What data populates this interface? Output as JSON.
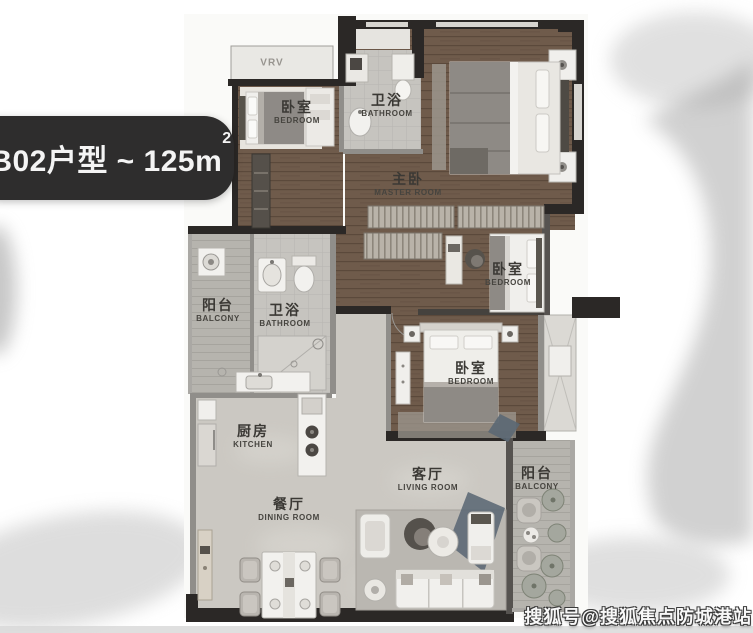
{
  "title": {
    "main": "B02户型 ~ 125m",
    "sup": "2"
  },
  "hvac": {
    "label": "VRV"
  },
  "rooms": [
    {
      "id": "bedroom-top-left",
      "cn": "卧室",
      "en": "BEDROOM"
    },
    {
      "id": "bathroom-top",
      "cn": "卫浴",
      "en": "BATHROOM"
    },
    {
      "id": "master-bedroom",
      "cn": "主卧",
      "en": "MASTER ROOM"
    },
    {
      "id": "bedroom-right",
      "cn": "卧室",
      "en": "BEDROOM"
    },
    {
      "id": "bedroom-bottom",
      "cn": "卧室",
      "en": "BEDROOM"
    },
    {
      "id": "balcony-left",
      "cn": "阳台",
      "en": "BALCONY"
    },
    {
      "id": "bathroom-left",
      "cn": "卫浴",
      "en": "BATHROOM"
    },
    {
      "id": "kitchen",
      "cn": "厨房",
      "en": "KITCHEN"
    },
    {
      "id": "dining-room",
      "cn": "餐厅",
      "en": "DINING ROOM"
    },
    {
      "id": "living-room",
      "cn": "客厅",
      "en": "LIVING ROOM"
    },
    {
      "id": "balcony-right",
      "cn": "阳台",
      "en": "BALCONY"
    }
  ],
  "watermark": "搜狐号@搜狐焦点防城港站",
  "colors": {
    "badge_bg": "#2e2d2d",
    "wall_dark": "#2b2826",
    "wall_gray": "#908e8a",
    "wood": "#6f5b4b",
    "marble": "#cbc8c2",
    "tile": "#c6c4bf",
    "balcony_deck": "#b6b4ae",
    "fabric_accent": "#5b6874",
    "label_text": "#3b3935",
    "watermark_text": "#f8f8f8"
  }
}
